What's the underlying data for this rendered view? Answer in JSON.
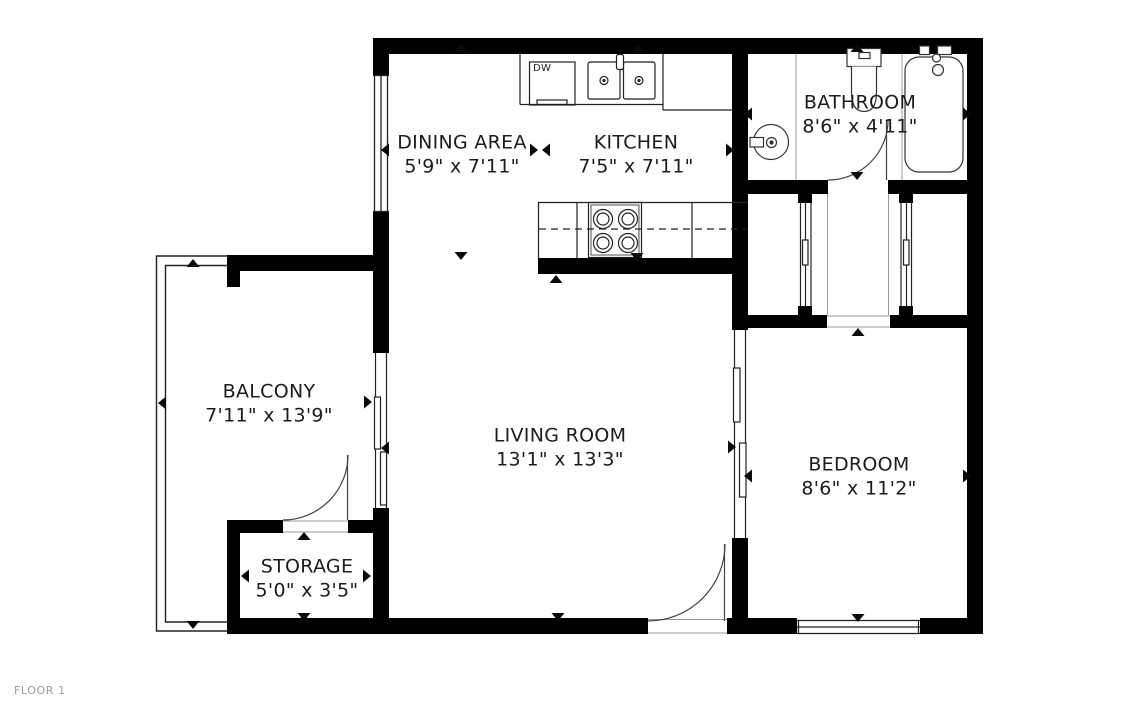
{
  "floor_label": "FLOOR 1",
  "rooms": [
    {
      "id": "dining-area",
      "name": "DINING AREA",
      "dimensions": "5'9\" x 7'11\""
    },
    {
      "id": "kitchen",
      "name": "KITCHEN",
      "dimensions": "7'5\" x 7'11\""
    },
    {
      "id": "bathroom",
      "name": "BATHROOM",
      "dimensions": "8'6\" x 4'11\""
    },
    {
      "id": "balcony",
      "name": "BALCONY",
      "dimensions": "7'11\" x 13'9\""
    },
    {
      "id": "living-room",
      "name": "LIVING ROOM",
      "dimensions": "13'1\" x 13'3\""
    },
    {
      "id": "bedroom",
      "name": "BEDROOM",
      "dimensions": "8'6\" x 11'2\""
    },
    {
      "id": "storage",
      "name": "STORAGE",
      "dimensions": "5'0\" x 3'5\""
    }
  ],
  "labels": {
    "dishwasher": "DW"
  },
  "colors": {
    "wall": "#000000",
    "background": "#ffffff",
    "room_text": "#1c1c1c",
    "floor_label_text": "#9b9b9b",
    "fixture_line": "#333333",
    "light_line": "#999999"
  }
}
